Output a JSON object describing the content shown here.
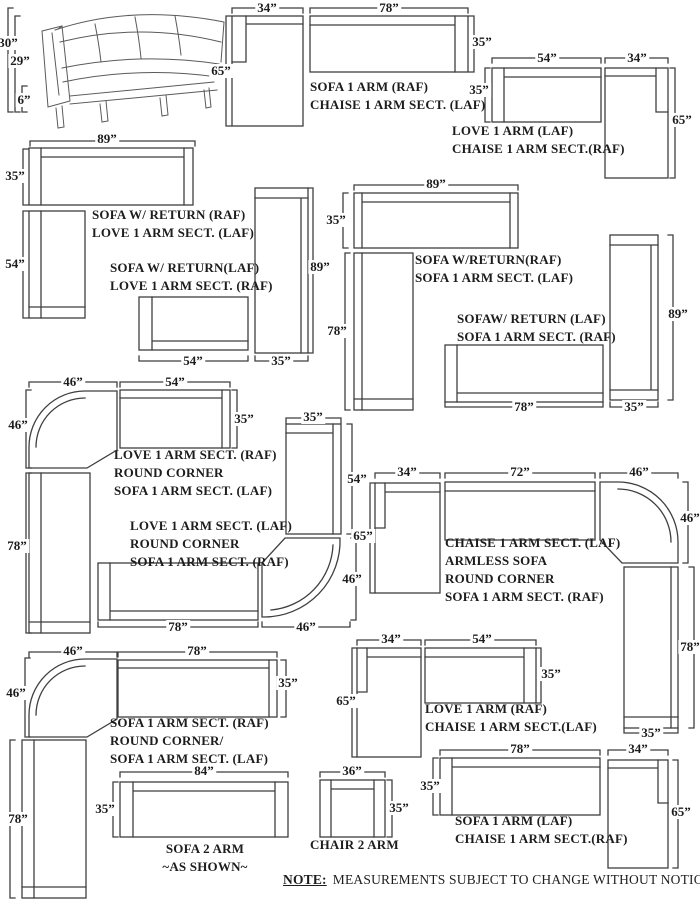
{
  "sketch": {
    "dims": {
      "height_back": "30”",
      "height_seatback": "29”",
      "leg": "6”"
    }
  },
  "groups": {
    "b": {
      "lines": [
        "SOFA 1 ARM (RAF)",
        "CHAISE 1 ARM SECT. (LAF)"
      ],
      "dims": {
        "chaise_w": "34”",
        "sofa_w": "78”",
        "sofa_d": "35”",
        "chaise_l": "65”"
      }
    },
    "c": {
      "lines": [
        "LOVE 1 ARM (LAF)",
        "CHAISE 1 ARM SECT.(RAF)"
      ],
      "dims": {
        "love_w": "54”",
        "chaise_w": "34”",
        "love_d": "35”",
        "chaise_l": "65”"
      }
    },
    "d": {
      "lines": [
        "SOFA W/ RETURN (RAF)",
        "LOVE 1 ARM SECT. (LAF)"
      ],
      "lines2": [
        "SOFA W/ RETURN(LAF)",
        "LOVE 1 ARM SECT. (RAF)"
      ],
      "dims": {
        "sofa_w": "89”",
        "sofa_d": "35”",
        "return_l": "54”",
        "love_w": "54”",
        "sect_w": "35”",
        "sect_l": "89”"
      }
    },
    "e": {
      "lines": [
        "SOFA W/RETURN(RAF)",
        "SOFA 1 ARM SECT. (LAF)"
      ],
      "lines2": [
        "SOFAW/ RETURN (LAF)",
        "SOFA 1 ARM SECT. (RAF)"
      ],
      "dims": {
        "sofa_w": "89”",
        "sofa_d": "35”",
        "return_l": "78”",
        "sofa2_w": "78”",
        "sect_w": "35”",
        "sect_l": "89”"
      }
    },
    "f": {
      "lines": [
        "LOVE 1 ARM SECT. (RAF)",
        "ROUND CORNER",
        "SOFA 1 ARM SECT. (LAF)"
      ],
      "dims": {
        "corner_w": "46”",
        "love_w": "54”",
        "corner_d": "46”",
        "love_d": "35”",
        "sofa_l": "78”"
      }
    },
    "g": {
      "lines": [
        "LOVE 1 ARM SECT. (LAF)",
        "ROUND CORNER",
        "SOFA 1 ARM SECT. (RAF)"
      ],
      "dims": {
        "love_w": "35”",
        "love_l": "54”",
        "sofa_w": "78”",
        "corner_w": "46”",
        "corner_d": "46”"
      }
    },
    "h": {
      "lines": [
        "CHAISE 1 ARM SECT. (LAF)",
        "ARMLESS SOFA",
        "ROUND CORNER",
        "SOFA 1 ARM SECT. (RAF)"
      ],
      "dims": {
        "chaise_w": "34”",
        "armless_w": "72”",
        "corner_w": "46”",
        "chaise_l": "65”",
        "corner_d": "46”",
        "sect_l": "78”",
        "sect_w": "35”"
      }
    },
    "i": {
      "lines": [
        "SOFA 1 ARM SECT. (RAF)",
        "ROUND CORNER/",
        "SOFA 1 ARM SECT. (LAF)"
      ],
      "dims": {
        "corner_w": "46”",
        "sofa_w": "78”",
        "sofa_d": "35”",
        "corner_d": "46”",
        "sect_l": "78”"
      }
    },
    "m": {
      "lines": [
        "LOVE 1 ARM (RAF)",
        "CHAISE 1 ARM SECT.(LAF)"
      ],
      "dims": {
        "chaise_w": "34”",
        "love_w": "54”",
        "chaise_l": "65”",
        "love_d": "35”"
      }
    },
    "j": {
      "lines": [
        "SOFA 2 ARM",
        "~AS SHOWN~"
      ],
      "dims": {
        "sofa_w": "84”",
        "sofa_d": "35”"
      }
    },
    "k": {
      "lines": [
        "CHAIR 2 ARM"
      ],
      "dims": {
        "chair_w": "36”",
        "chair_d": "35”"
      }
    },
    "l": {
      "lines": [
        "SOFA 1 ARM (LAF)",
        "CHAISE 1 ARM SECT.(RAF)"
      ],
      "dims": {
        "sofa_w": "78”",
        "chaise_w": "34”",
        "sofa_d": "35”",
        "chaise_l": "65”"
      }
    }
  },
  "note": {
    "label": "NOTE:",
    "text": "MEASUREMENTS SUBJECT TO CHANGE WITHOUT NOTICE."
  }
}
